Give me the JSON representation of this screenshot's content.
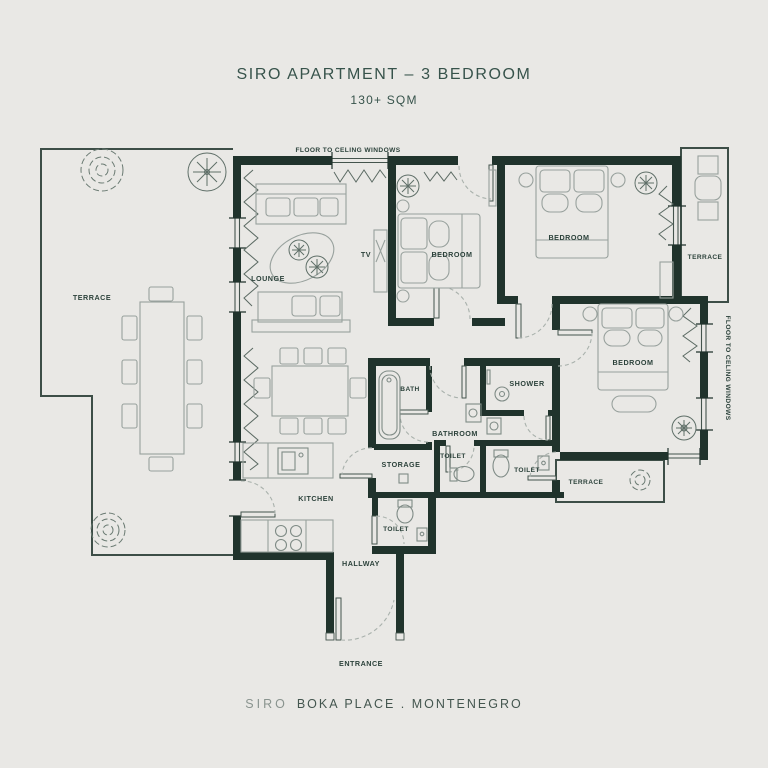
{
  "header": {
    "title": "SIRO APARTMENT – 3 BEDROOM",
    "subtitle": "130+ SQM"
  },
  "footer": {
    "brand": "SIRO",
    "location": "BOKA PLACE . MONTENEGRO"
  },
  "annotations": {
    "window_top": "FLOOR TO CELING WINDOWS",
    "window_right": "FLOOR TO CELING WINDOWS"
  },
  "rooms": {
    "terrace_left": "TERRACE",
    "lounge": "LOUNGE",
    "tv": "TV",
    "bedroom_1": "BEDROOM",
    "bedroom_2": "BEDROOM",
    "bedroom_3": "BEDROOM",
    "terrace_top_right": "TERRACE",
    "terrace_bottom_right": "TERRACE",
    "bath": "BATH",
    "shower": "SHOWER",
    "bathroom": "BATHROOM",
    "toilet_1": "TOILET",
    "toilet_2": "TOILET",
    "toilet_3": "TOILET",
    "storage": "STORAGE",
    "kitchen": "KITCHEN",
    "hallway": "HALLWAY",
    "entrance": "ENTRANCE"
  },
  "colors": {
    "background": "#e9e8e5",
    "wall": "#20332c",
    "accent_text": "#37534b",
    "furniture_line": "#98a19d"
  }
}
